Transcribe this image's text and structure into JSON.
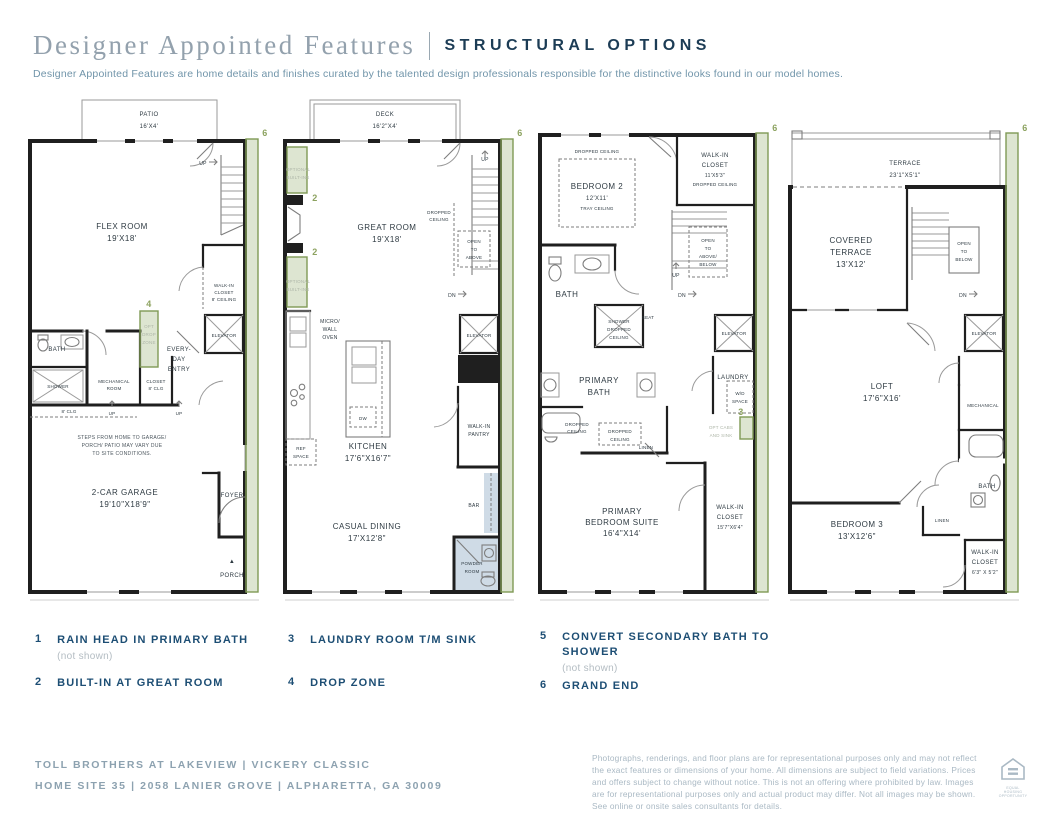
{
  "header": {
    "title": "Designer Appointed Features",
    "tag": "STRUCTURAL OPTIONS",
    "subtitle": "Designer Appointed Features are home details and finishes curated by the talented design professionals responsible for the distinctive looks found in our model homes."
  },
  "colors": {
    "accent_green": "#8fa968",
    "navy": "#1d4e74",
    "steel": "#7195aa",
    "shade_blue": "#cfdbe6"
  },
  "plans": {
    "p1": {
      "marker6": "6",
      "patio": "PATIO",
      "patio_dim": "16'X4'",
      "up": "UP",
      "flex": "FLEX ROOM",
      "flex_dim": "19'X18'",
      "wic1": "WALK-IN",
      "wic2": "CLOSET",
      "wic3": "8' CEILING",
      "opt4": "4",
      "dz1": "OPT",
      "dz2": "DROP",
      "dz3": "ZONE",
      "elevator": "ELEVATOR",
      "entry1": "EVERY-",
      "entry2": "DAY",
      "entry3": "ENTRY",
      "bath": "BATH",
      "shower": "SHOWER",
      "mech1": "MECHANICAL",
      "mech2": "ROOM",
      "closet1": "CLOSET",
      "closet2": "8' CLG",
      "clg8": "8' CLG",
      "up2": "UP",
      "up3": "UP",
      "note1": "STEPS FROM HOME TO GARAGE/",
      "note2": "PORCH/ PATIO MAY VARY DUE",
      "note3": "TO SITE CONDITIONS.",
      "garage": "2-CAR GARAGE",
      "garage_dim": "19'10\"X18'9\"",
      "foyer": "FOYER",
      "porch": "PORCH"
    },
    "p2": {
      "marker6": "6",
      "deck": "DECK",
      "deck_dim": "16'2\"X4'",
      "ob1a": "OPTIONAL",
      "ob1b": "BUILT-INS",
      "num2a": "2",
      "ob2a": "OPTIONAL",
      "ob2b": "BUILT-INS",
      "num2b": "2",
      "great": "GREAT ROOM",
      "great_dim": "19'X18'",
      "up": "UP",
      "dc1": "DROPPED",
      "dc2": "CEILING",
      "oa1": "OPEN",
      "oa2": "TO",
      "oa3": "ABOVE",
      "dn": "DN",
      "micro1": "MICRO/",
      "micro2": "WALL",
      "micro3": "OVEN",
      "elevator": "ELEVATOR",
      "dw": "DW",
      "ref1": "REF",
      "ref2": "SPACE",
      "kitchen": "KITCHEN",
      "kitchen_dim": "17'6\"X16'7\"",
      "pantry1": "WALK-IN",
      "pantry2": "PANTRY",
      "bar": "BAR",
      "dining": "CASUAL DINING",
      "dining_dim": "17'X12'8\"",
      "powder1": "POWDER",
      "powder2": "ROOM"
    },
    "p3": {
      "marker6": "6",
      "dc_top": "DROPPED CEILING",
      "bed2": "BEDROOM 2",
      "bed2_dim": "12'X11'",
      "bed2_note": "TRAY CEILING",
      "wic1": "WALK-IN",
      "wic2": "CLOSET",
      "wic_dim": "11'X5'3\"",
      "wic_note": "DROPPED CEILING",
      "oab1": "OPEN",
      "oab2": "TO",
      "oab3": "ABOVE/",
      "oab4": "BELOW",
      "up": "UP",
      "dn": "DN",
      "bath": "BATH",
      "sh1": "SHOWER",
      "sh2": "DROPPED",
      "sh3": "CEILING",
      "seat": "SEAT",
      "elevator": "ELEVATOR",
      "pbath1": "PRIMARY",
      "pbath2": "BATH",
      "laundry": "LAUNDRY",
      "wd1": "W/D",
      "wd2": "SPACE",
      "num3": "3",
      "optcab1": "OPT CABS",
      "optcab2": "AND SINK",
      "dc1a": "DROPPED",
      "dc1b": "CEILING",
      "dc2a": "DROPPED",
      "dc2b": "CEILING",
      "linen": "LINEN",
      "suite1": "PRIMARY",
      "suite2": "BEDROOM SUITE",
      "suite_dim": "16'4\"X14'",
      "wicb1": "WALK-IN",
      "wicb2": "CLOSET",
      "wicb_dim": "15'7\"X6'4\""
    },
    "p4": {
      "marker6": "6",
      "terrace": "TERRACE",
      "terrace_dim": "23'1\"X5'1\"",
      "ct1": "COVERED",
      "ct2": "TERRACE",
      "ct_dim": "13'X12'",
      "ob1": "OPEN",
      "ob2": "TO",
      "ob3": "BELOW",
      "dn": "DN",
      "elevator": "ELEVATOR",
      "loft": "LOFT",
      "loft_dim": "17'6\"X16'",
      "mech": "MECHANICAL",
      "bath": "BATH",
      "linen": "LINEN",
      "bed3": "BEDROOM 3",
      "bed3_dim": "13'X12'6\"",
      "wic1": "WALK-IN",
      "wic2": "CLOSET",
      "wic_dim": "6'3\" X 5'2\""
    }
  },
  "legend": {
    "items": [
      {
        "num": "1",
        "label": "RAIN HEAD IN PRIMARY BATH",
        "note": "(not shown)"
      },
      {
        "num": "2",
        "label": "BUILT-IN AT GREAT ROOM",
        "note": ""
      },
      {
        "num": "3",
        "label": "LAUNDRY ROOM T/M SINK",
        "note": ""
      },
      {
        "num": "4",
        "label": "DROP ZONE",
        "note": ""
      },
      {
        "num": "5",
        "label": "CONVERT SECONDARY BATH TO SHOWER",
        "note": "(not shown)"
      },
      {
        "num": "6",
        "label": "GRAND END",
        "note": ""
      }
    ]
  },
  "footer": {
    "line1": "TOLL BROTHERS AT LAKEVIEW | VICKERY CLASSIC",
    "line2": "HOME SITE 35 | 2058 LANIER GROVE | ALPHARETTA, GA 30009",
    "disclaimer": "Photographs, renderings, and floor plans are for representational purposes only and may not reflect the exact features or dimensions of your home. All dimensions are subject to field variations. Prices and offers subject to change without notice. This is not an offering where prohibited by law. Images are for representational purposes only and actual product may differ. Not all images may be shown. See online or onsite sales consultants for details.",
    "logo_label": "EQUAL HOUSING OPPORTUNITY"
  }
}
